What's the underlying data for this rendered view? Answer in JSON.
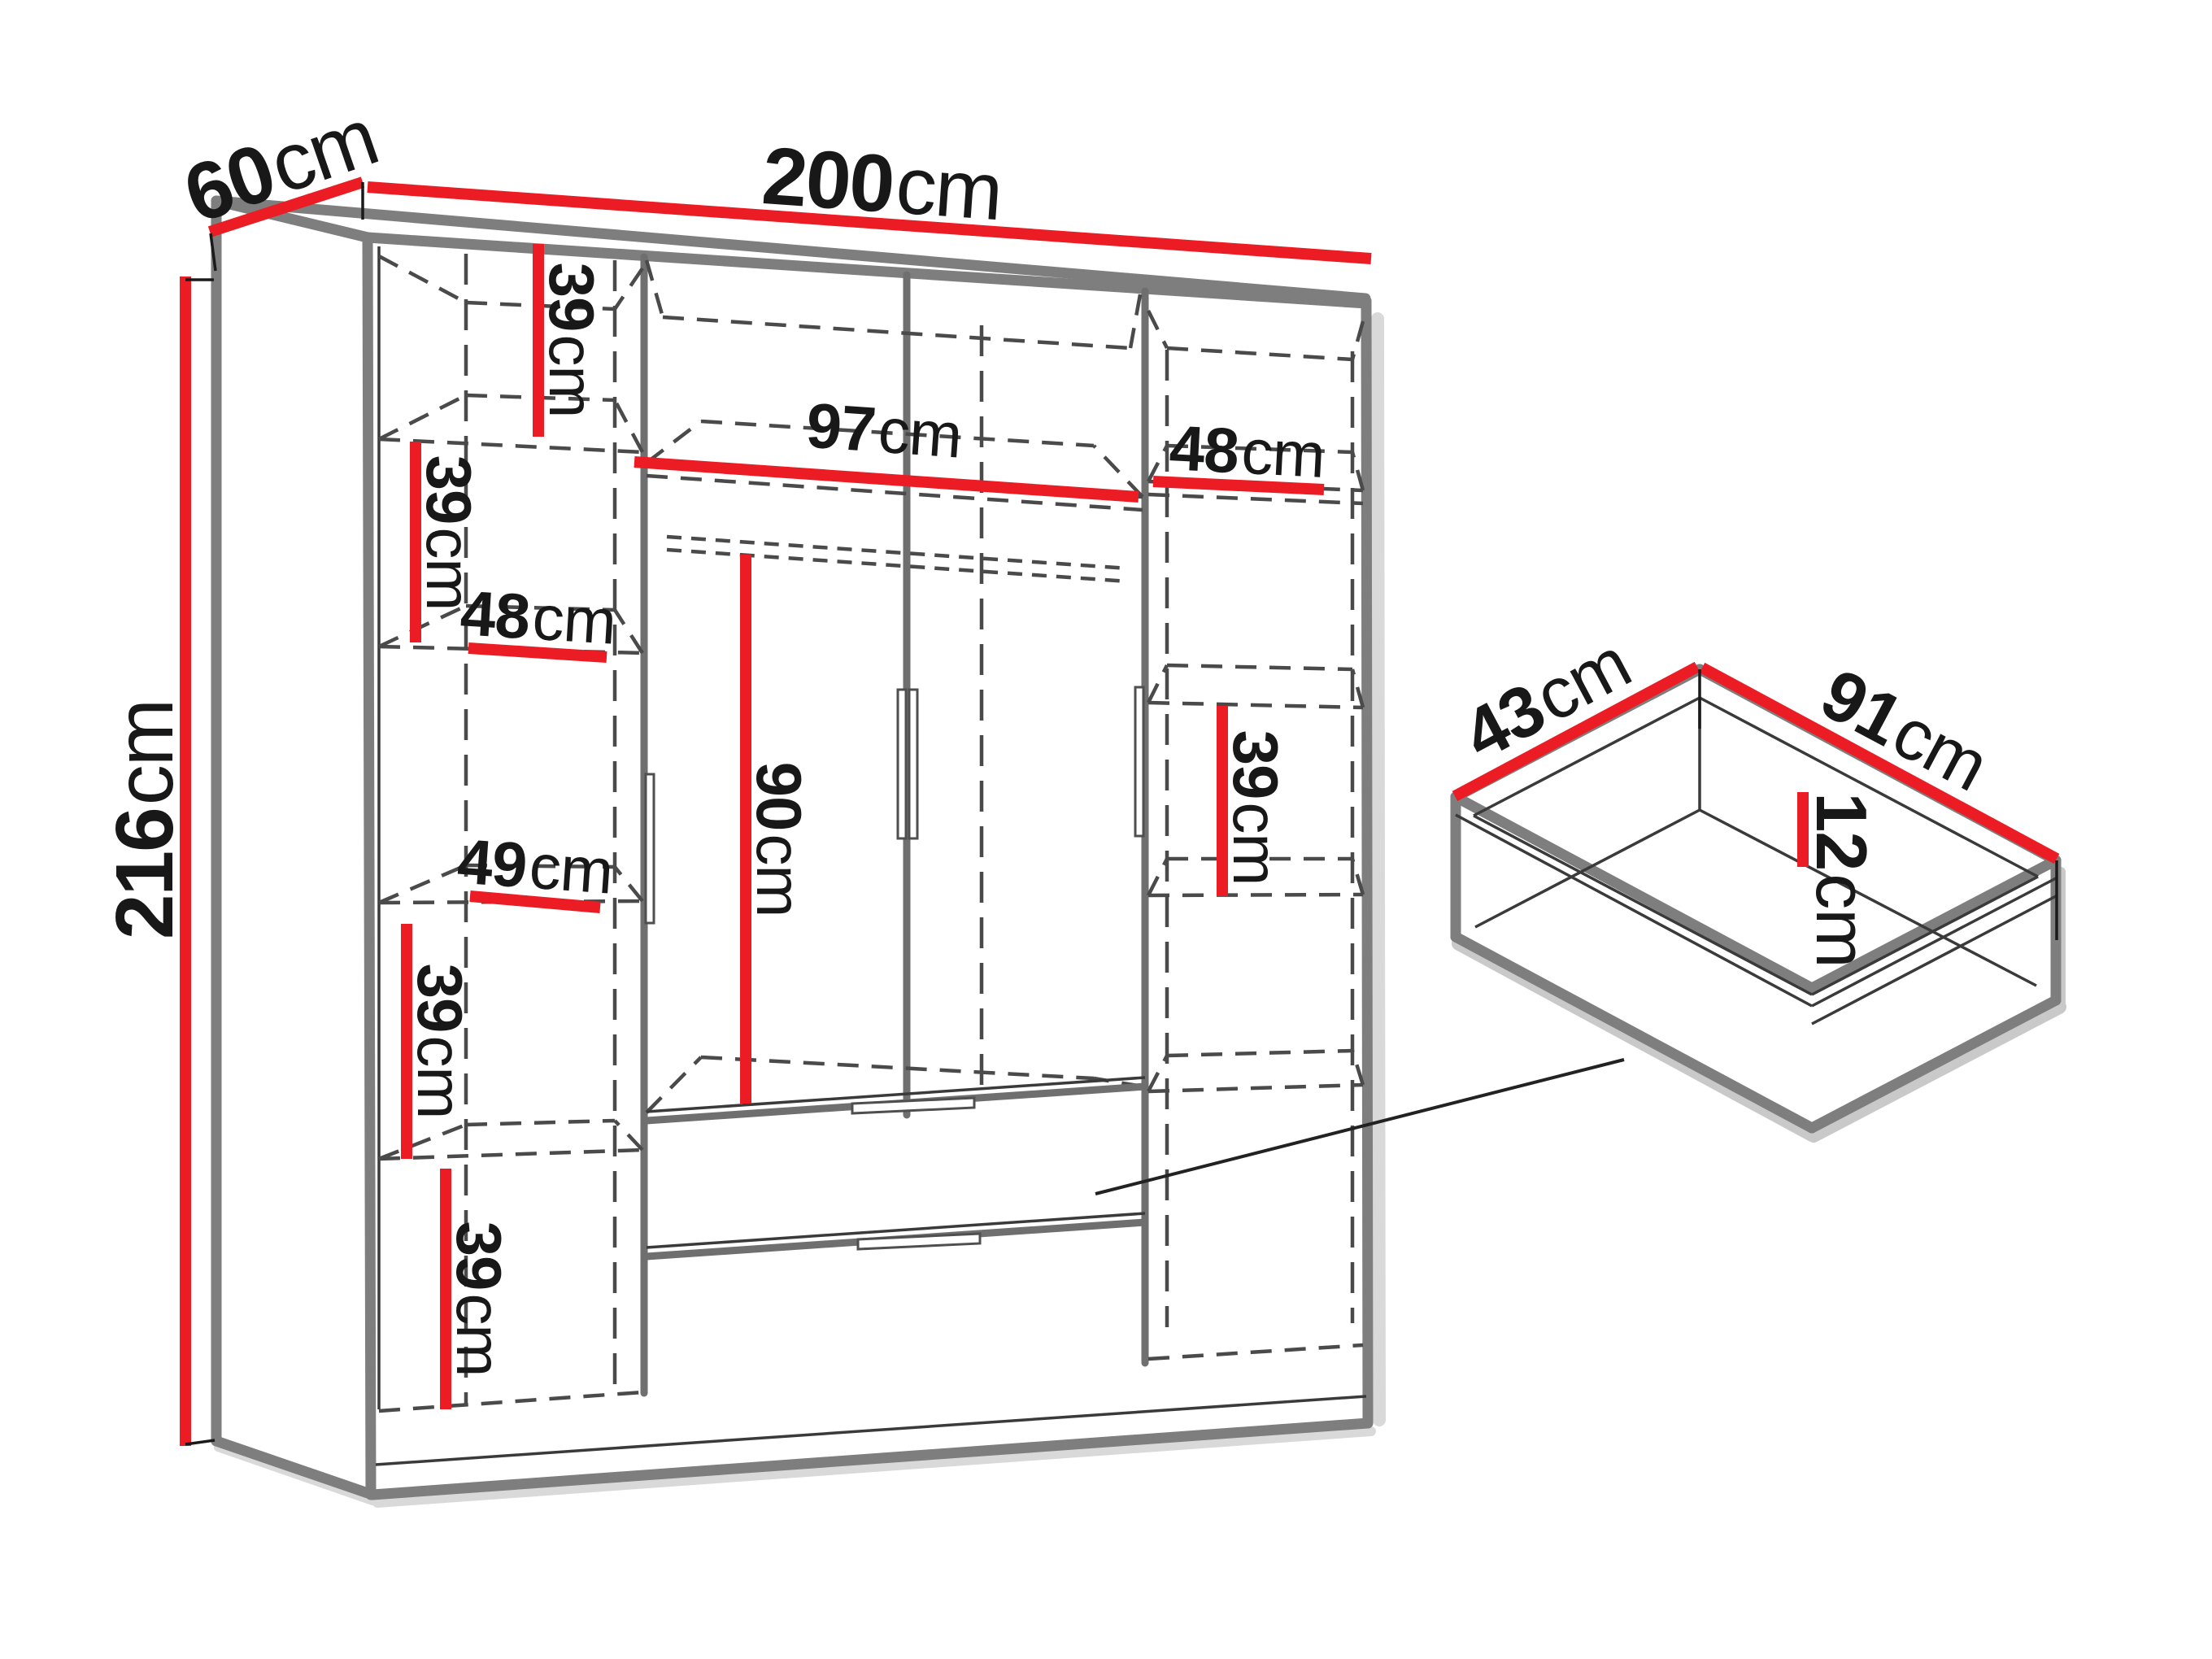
{
  "colors": {
    "dimension_red": "#ec1c24",
    "edge_gray": "#7e7e7e",
    "dash_gray": "#4a4a4a",
    "text": "#181818"
  },
  "wardrobe": {
    "overall": {
      "depth": {
        "v": "60",
        "u": "cm"
      },
      "width": {
        "v": "200",
        "u": "cm"
      },
      "height": {
        "v": "216",
        "u": "cm"
      }
    },
    "interior": {
      "shelf_top_left": {
        "v": "39",
        "u": "cm"
      },
      "shelf_upper_left": {
        "v": "39",
        "u": "cm"
      },
      "shelf_width_left_upper": {
        "v": "48",
        "u": "cm"
      },
      "shelf_width_left_lower": {
        "v": "49",
        "u": "cm"
      },
      "shelf_lower_left": {
        "v": "39",
        "u": "cm"
      },
      "shelf_bottom_left": {
        "v": "39",
        "u": "cm"
      },
      "hanging_width": {
        "v": "97",
        "u": "cm"
      },
      "hanging_height": {
        "v": "90",
        "u": "cm"
      },
      "shelf_width_right": {
        "v": "48",
        "u": "cm"
      },
      "shelf_right": {
        "v": "39",
        "u": "cm"
      }
    }
  },
  "drawer_detail": {
    "depth": {
      "v": "43",
      "u": "cm"
    },
    "width": {
      "v": "91",
      "u": "cm"
    },
    "height": {
      "v": "12",
      "u": "cm"
    }
  }
}
